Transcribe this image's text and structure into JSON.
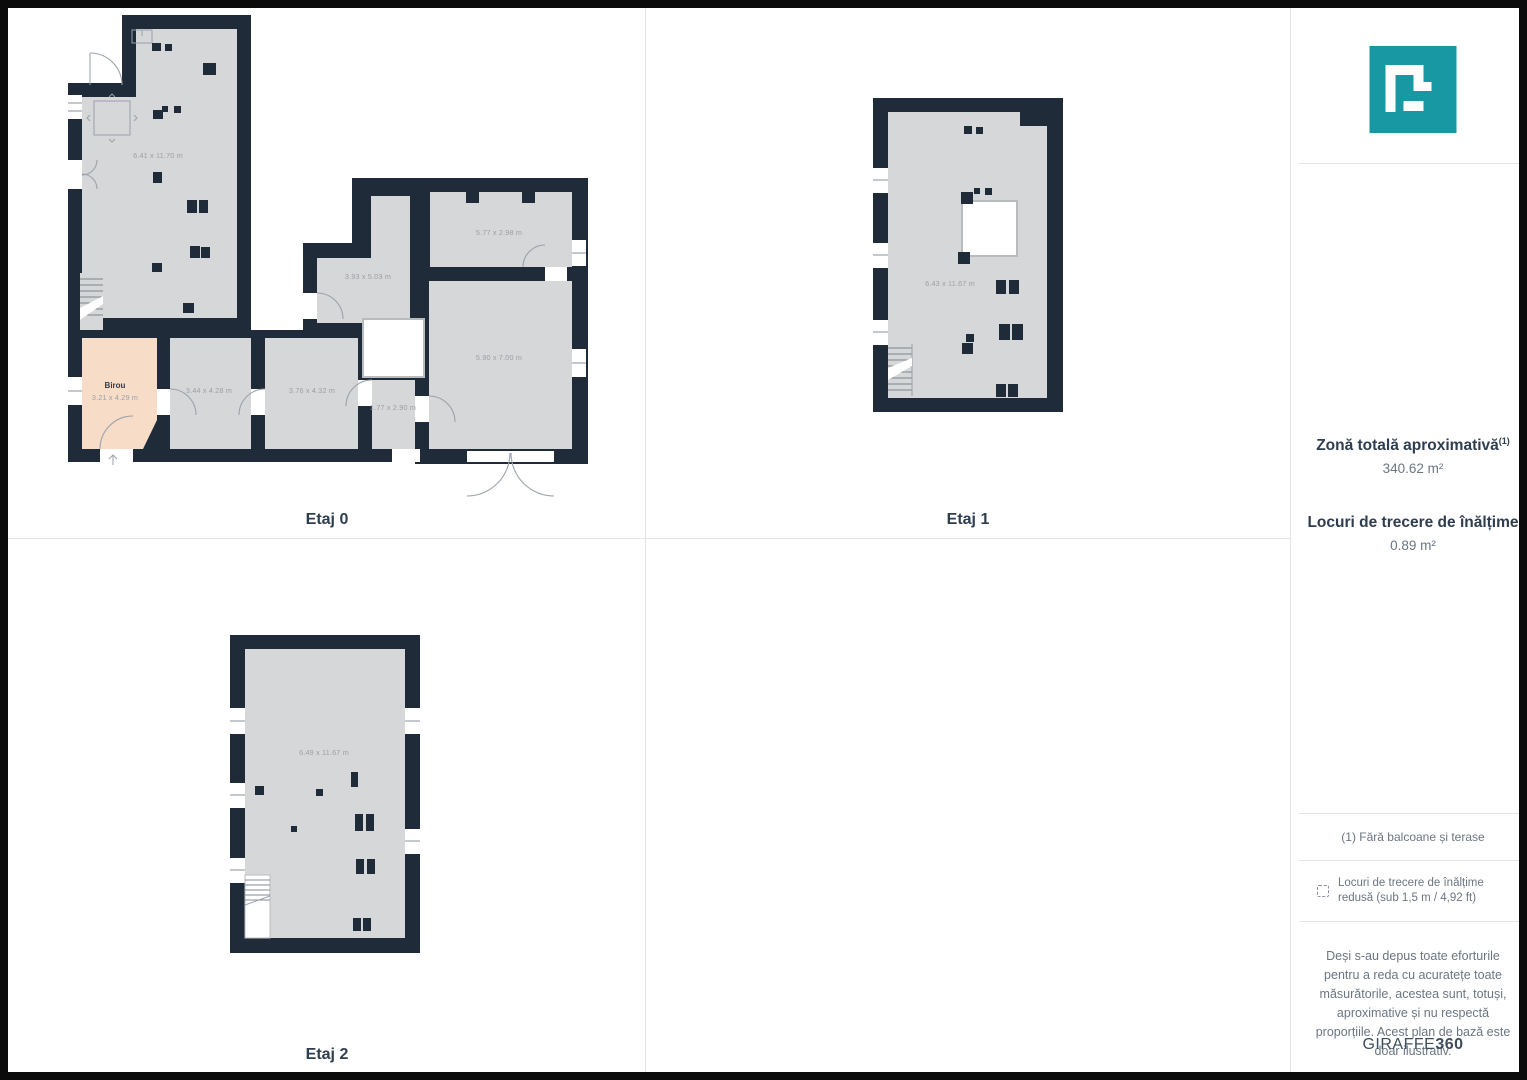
{
  "theme": {
    "wall": "#1f2b39",
    "floor": "#d6d7d8",
    "birou": "#f7dcc8",
    "accent": "#1898a2",
    "line": "#e4e4e4",
    "text_dark": "#2e3d4f",
    "text_gray": "#6b7683",
    "dim_text": "#9aa0a6"
  },
  "floors": [
    {
      "name": "Etaj 0",
      "rooms": [
        {
          "label": "6.41 x 11.70 m"
        },
        {
          "name": "Birou",
          "label": "3.21 x 4.29 m"
        },
        {
          "label": "3.44 x 4.28 m"
        },
        {
          "label": "3.76 x 4.32 m"
        },
        {
          "label": "1.77 x 2.90 m"
        },
        {
          "label": "3.93 x 5.03 m"
        },
        {
          "label": "5.77 x 2.98 m"
        },
        {
          "label": "5.90 x 7.00 m"
        }
      ]
    },
    {
      "name": "Etaj 1",
      "rooms": [
        {
          "label": "6.43 x 11.67 m"
        }
      ]
    },
    {
      "name": "Etaj 2",
      "rooms": [
        {
          "label": "6.49 x 11.67 m"
        }
      ]
    }
  ],
  "sidebar": {
    "area_title": "Zonă totală aproximativă",
    "area_title_sup": "(1)",
    "area_value": "340.62 m²",
    "passage_title": "Locuri de trecere de înălțime",
    "passage_value": "0.89 m²",
    "footnote": "(1) Fără balcoane și terase",
    "legend_text": "Locuri de trecere de înălțime redusă (sub 1,5 m / 4,92 ft)",
    "disclaimer": "Deși s-au depus toate eforturile pentru a reda cu acuratețe toate măsurătorile, acestea sunt, totuși, aproximative și nu respectă proporțiile. Acest plan de bază este doar ilustrativ.",
    "brand": "GIRAFFE",
    "brand_bold": "360"
  }
}
